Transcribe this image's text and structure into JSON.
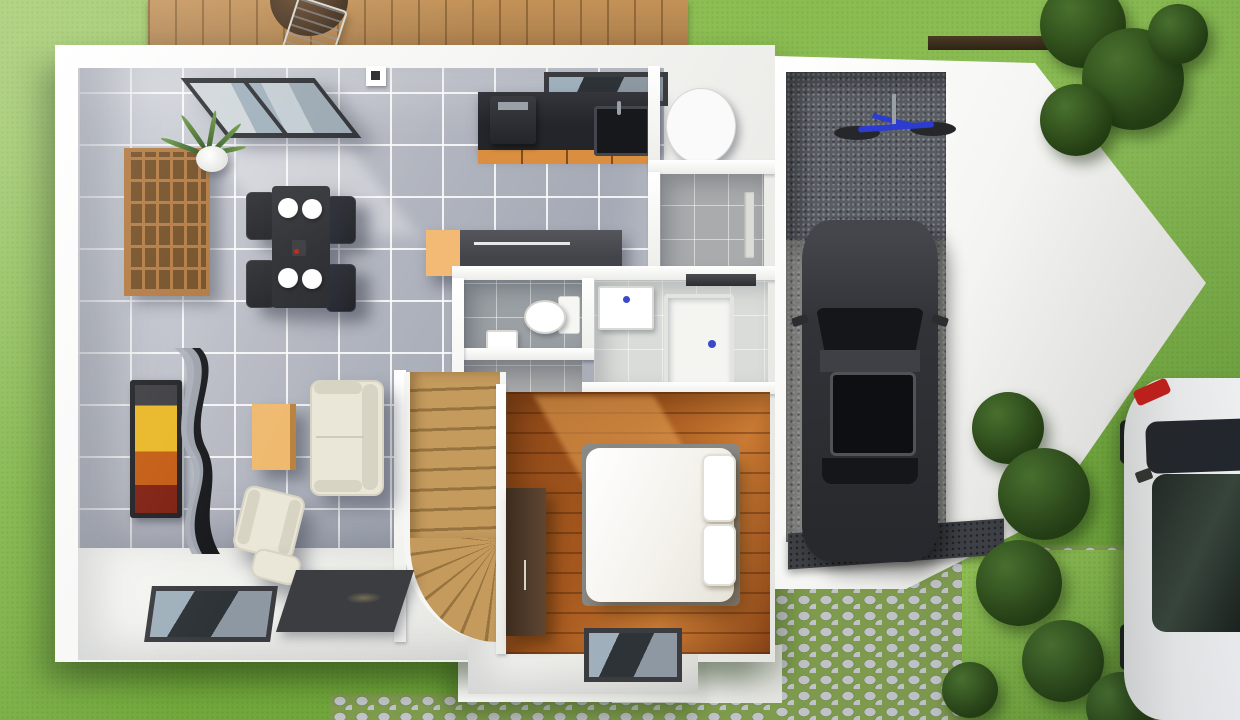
{
  "meta": {
    "title": "Top-down 3D architectural render of a single-storey house floor plan with garage, garden, wooden deck and cobblestone driveway"
  },
  "colors": {
    "grass": "#7cb342",
    "grass_light": "#95c457",
    "grass_dark": "#649a33",
    "deck_wood": "#c39258",
    "deck_line": "#ab7f4c",
    "wall_white": "#f6f6f4",
    "wall_shade": "#e4e4e0",
    "tile_floor": "#b7bac3",
    "tile_light": "#d3d7dd",
    "tile_dark": "#a4a9b5",
    "hall_tile": "#a9abac",
    "wc_tile": "#9aa0a4",
    "bath_floor": "#dadcd9",
    "wood_floor": "#a5581e",
    "wood_sun": "#e6a355",
    "stairs_wood": "#c49a5d",
    "stairs_wood_dark": "#97743f",
    "counter_dark": "#23252a",
    "cabinet_orange": "#d98f3f",
    "island_dark": "#42444a",
    "island_orange": "#f2ba74",
    "table_black": "#2b2d31",
    "chair_black": "#222428",
    "shelf_wood": "#b0763c",
    "shelf_hole": "#6f4a20",
    "sofa_cream": "#eae6d8",
    "sofa_shade": "#d8d4c4",
    "coffee_table": "#efb96f",
    "tv_frame": "#1e1f23",
    "tv_yellow": "#e9b623",
    "tv_orange": "#c2590f",
    "rug_dark": "#3b3d41",
    "frame_dark": "#3a3c40",
    "glass_dark": "#2e3338",
    "glass_light": "#9fb0bc",
    "garage_dark": "#585c63",
    "garage_light": "#a3a3a1",
    "mat_dark": "#3e4045",
    "car_dark": "#323338",
    "car_glass": "#14161a",
    "white_car": "#f1f2f1",
    "white_car_glass": "#222a23",
    "taillight": "#c41f1a",
    "cobble_stone": "#c1c4c7",
    "cobble_joint": "#7f9c4d",
    "bush": "#4a7030",
    "bush_dark": "#243d14",
    "heater": "#fafafa",
    "bike_blue": "#2c3bd0",
    "bed_white": "#f4f2ec",
    "wardrobe": "#4c3828"
  },
  "scene": {
    "outdoor": [
      {
        "id": "garden",
        "label": "lawn garden"
      },
      {
        "id": "deck",
        "label": "wooden terrace",
        "items": [
          "round table",
          "white folding chair"
        ]
      },
      {
        "id": "driveway",
        "label": "cobblestone driveway"
      },
      {
        "id": "path",
        "label": "cobblestone path"
      },
      {
        "id": "planting",
        "label": "bushes and trees"
      }
    ],
    "rooms": [
      {
        "id": "living-dining",
        "label": "living / dining room",
        "floor": "grey tiles",
        "items": [
          "cube shelf",
          "potted plant",
          "roof window",
          "dining table",
          "four chairs",
          "four plates",
          "wall TV",
          "curved TV stand",
          "coffee table",
          "sofa",
          "armchair",
          "dark rug",
          "floor window"
        ]
      },
      {
        "id": "kitchen",
        "label": "kitchen",
        "items": [
          "counter with black sink",
          "coffee machine",
          "orange cabinets",
          "island unit",
          "window"
        ]
      },
      {
        "id": "utility",
        "label": "utility room",
        "items": [
          "water heater cylinder"
        ]
      },
      {
        "id": "hallway",
        "label": "hallway to garage",
        "items": [
          "garage door"
        ]
      },
      {
        "id": "wc",
        "label": "toilet room",
        "items": [
          "toilet",
          "hand basin"
        ]
      },
      {
        "id": "bathroom",
        "label": "bathroom",
        "items": [
          "washbasin",
          "shower tray"
        ]
      },
      {
        "id": "vestibule",
        "label": "entry vestibule"
      },
      {
        "id": "staircase",
        "label": "winder staircase"
      },
      {
        "id": "bedroom",
        "label": "bedroom",
        "floor": "wood planks",
        "items": [
          "double bed",
          "pillows",
          "wardrobe",
          "floor window"
        ]
      },
      {
        "id": "garage",
        "label": "garage",
        "items": [
          "dark car",
          "blue bicycle",
          "entrance mat"
        ]
      }
    ],
    "vehicles": [
      {
        "id": "car-dark",
        "label": "dark hatchback parked in garage"
      },
      {
        "id": "car-white",
        "label": "white car parked on driveway"
      },
      {
        "id": "bicycle",
        "label": "blue bicycle"
      }
    ]
  }
}
